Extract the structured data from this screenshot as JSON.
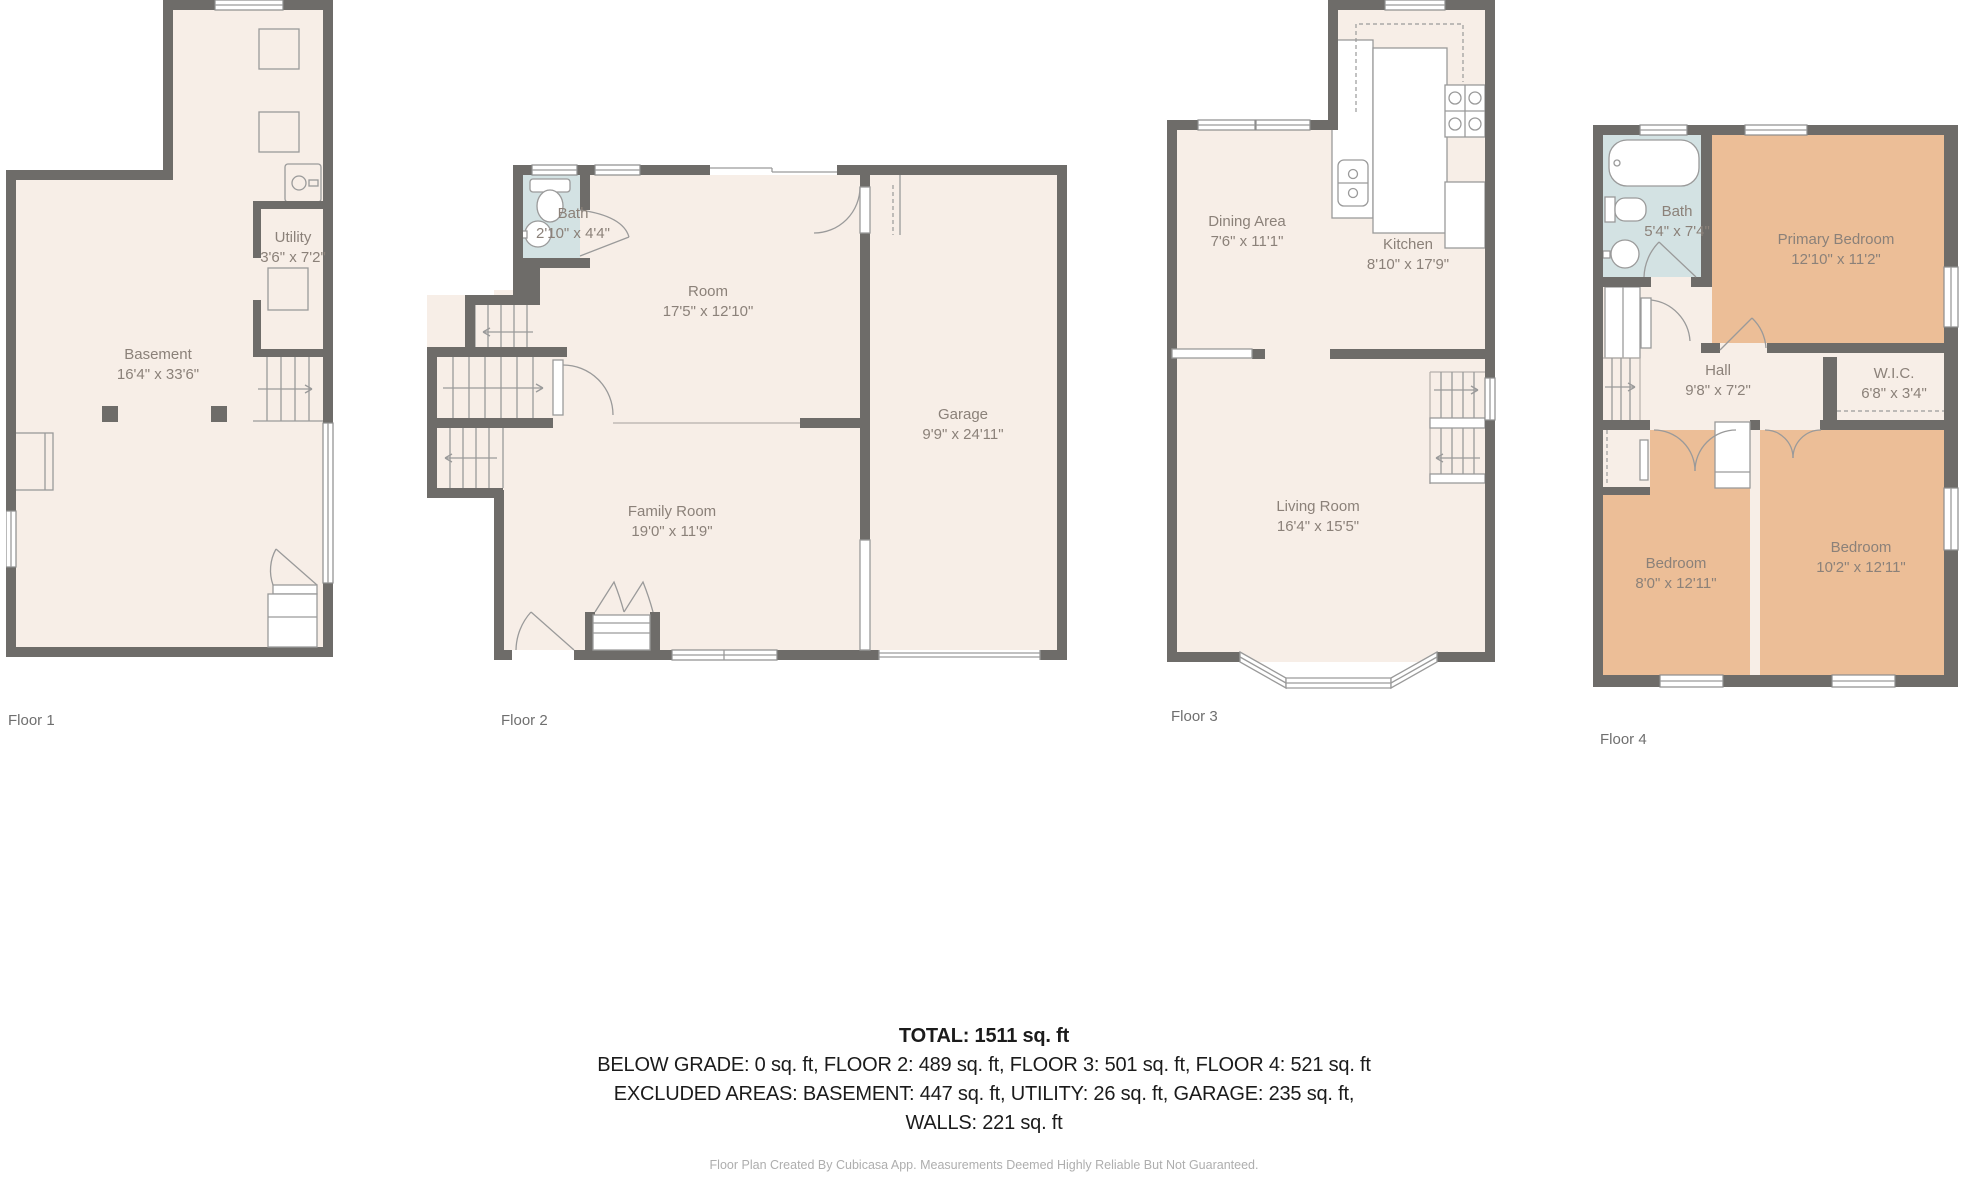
{
  "palette": {
    "wall": "#6e6c69",
    "floor_fill": "#f7eee7",
    "bath_fill": "#d3e2e3",
    "bedroom_fill": "#ecbe97",
    "fixture_line": "#9a9a9a",
    "room_label_text": "#8b8179",
    "caption_text": "#6f6f6f",
    "summary_text": "#1b1b1b",
    "footer_text": "#aeaeae"
  },
  "floors": [
    {
      "caption": "Floor 1",
      "rooms": [
        {
          "name": "Basement",
          "dims": "16'4\" x 33'6\""
        },
        {
          "name": "Utility",
          "dims": "3'6\" x 7'2\""
        }
      ]
    },
    {
      "caption": "Floor 2",
      "rooms": [
        {
          "name": "Bath",
          "dims": "2'10\" x 4'4\""
        },
        {
          "name": "Room",
          "dims": "17'5\" x 12'10\""
        },
        {
          "name": "Family Room",
          "dims": "19'0\" x 11'9\""
        },
        {
          "name": "Garage",
          "dims": "9'9\" x 24'11\""
        }
      ]
    },
    {
      "caption": "Floor 3",
      "rooms": [
        {
          "name": "Dining Area",
          "dims": "7'6\" x 11'1\""
        },
        {
          "name": "Kitchen",
          "dims": "8'10\" x 17'9\""
        },
        {
          "name": "Living Room",
          "dims": "16'4\" x 15'5\""
        }
      ]
    },
    {
      "caption": "Floor 4",
      "rooms": [
        {
          "name": "Bath",
          "dims": "5'4\" x 7'4\""
        },
        {
          "name": "Primary Bedroom",
          "dims": "12'10\" x 11'2\""
        },
        {
          "name": "Hall",
          "dims": "9'8\" x 7'2\""
        },
        {
          "name": "W.I.C.",
          "dims": "6'8\" x 3'4\""
        },
        {
          "name": "Bedroom",
          "dims": "8'0\" x 12'11\""
        },
        {
          "name": "Bedroom",
          "dims": "10'2\" x 12'11\""
        }
      ]
    }
  ],
  "summary": {
    "total": "TOTAL: 1511 sq. ft",
    "line2": "BELOW GRADE: 0 sq. ft, FLOOR 2: 489 sq. ft, FLOOR 3: 501 sq. ft, FLOOR 4: 521 sq. ft",
    "line3": "EXCLUDED AREAS: BASEMENT: 447 sq. ft, UTILITY: 26 sq. ft, GARAGE: 235 sq. ft,",
    "line4": "WALLS: 221 sq. ft"
  },
  "footer": "Floor Plan Created By Cubicasa App. Measurements Deemed Highly Reliable But Not Guaranteed."
}
